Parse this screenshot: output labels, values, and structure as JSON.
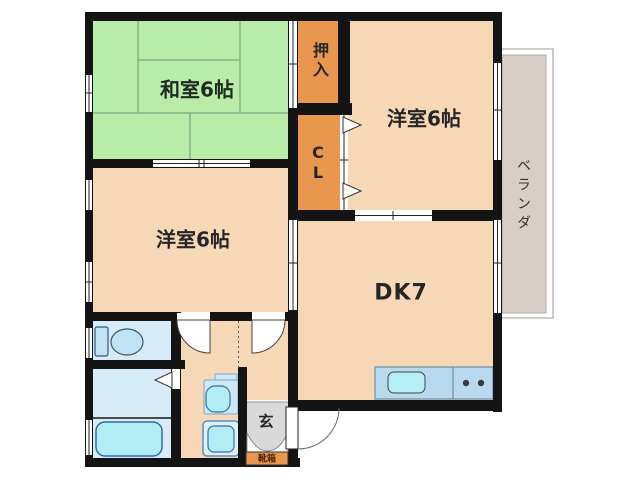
{
  "rooms": {
    "washitsu": "和室6帖",
    "oshiire": "押入",
    "yoshitsu_right": "洋室6帖",
    "closet_cl": "C\nL",
    "yoshitsu_left": "洋室6帖",
    "dining_kitchen": "DK7",
    "veranda": "ベランダ",
    "genkan": "玄",
    "shoebox": "靴箱"
  },
  "colors": {
    "wall": "#141414",
    "tatami_room": "#b9eca8",
    "tatami_line": "#8cae85",
    "western_room": "#f6d8b7",
    "closet": "#e9964e",
    "veranda": "#d8cec6",
    "genkan_floor": "#d9d9d9",
    "sanitary_room": "#d7ebf8",
    "fixture_fill": "#b2edf5",
    "fixture_outline": "#3a6ea8",
    "kitchen_counter": "#b9d9ef",
    "shoebox": "#e9964e"
  }
}
